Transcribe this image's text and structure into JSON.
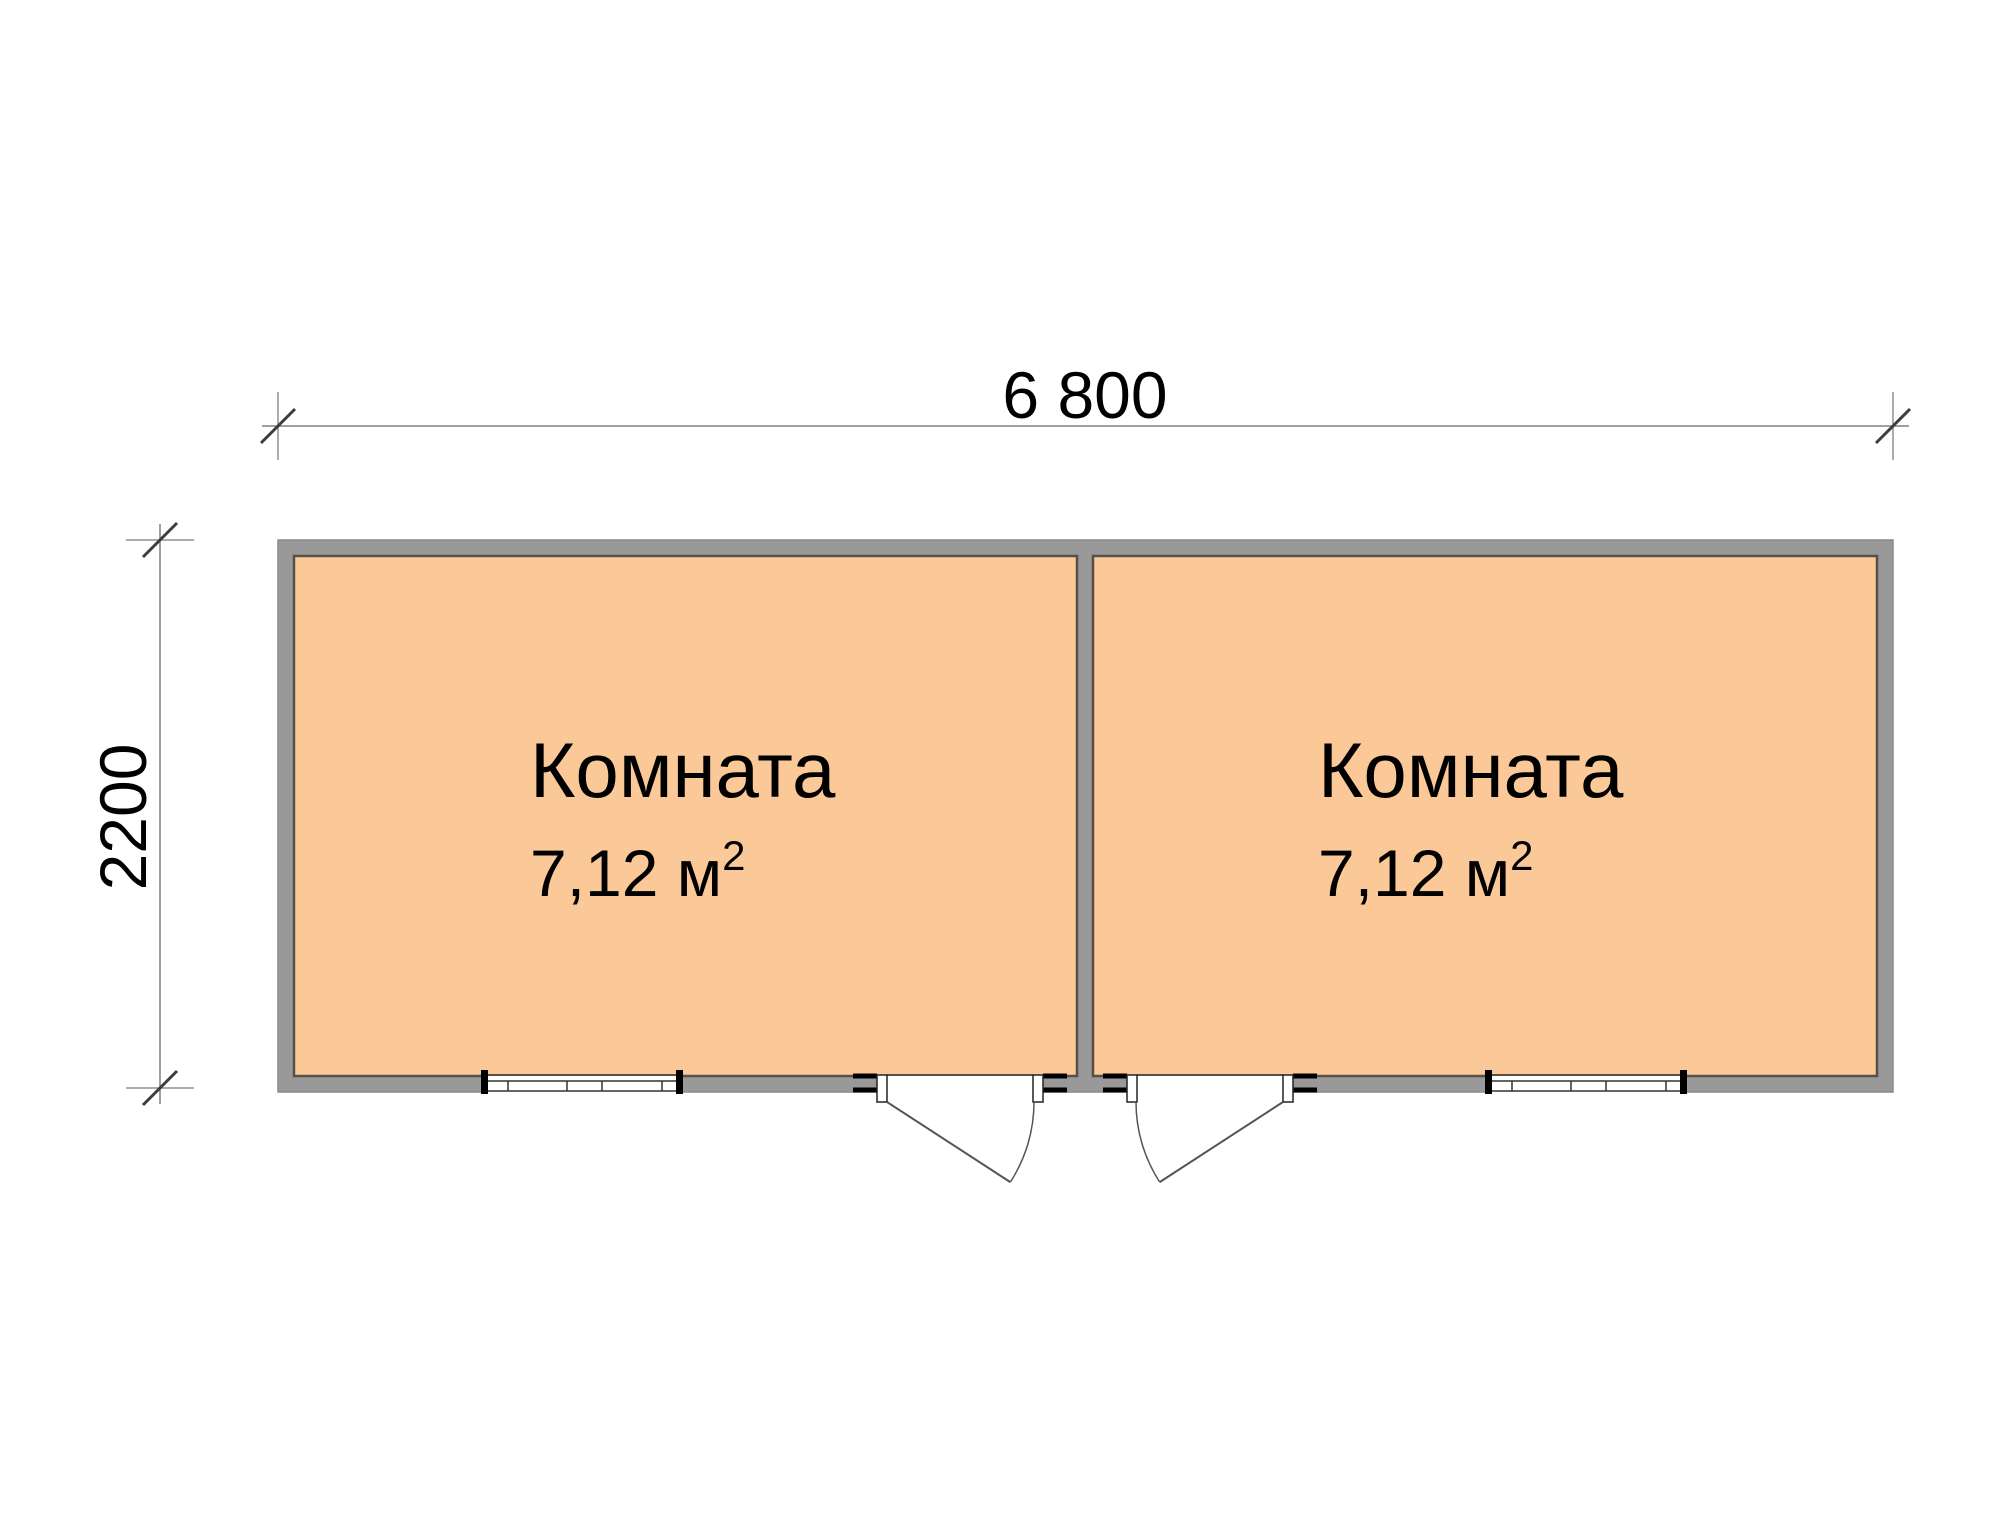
{
  "dimensions": {
    "width_label": "6 800",
    "height_label": "2200"
  },
  "rooms": [
    {
      "name": "Комната",
      "area": "7,12 м",
      "area_sup": "2"
    },
    {
      "name": "Комната",
      "area": "7,12 м",
      "area_sup": "2"
    }
  ],
  "colors": {
    "room_fill": "#fbc997",
    "wall_fill": "#999999",
    "wall_edge": "#57504a",
    "dim_line": "#808080",
    "tick_slash": "#3d3d3d",
    "opening_line": "#333333",
    "text": "#000000",
    "background": "#ffffff"
  }
}
